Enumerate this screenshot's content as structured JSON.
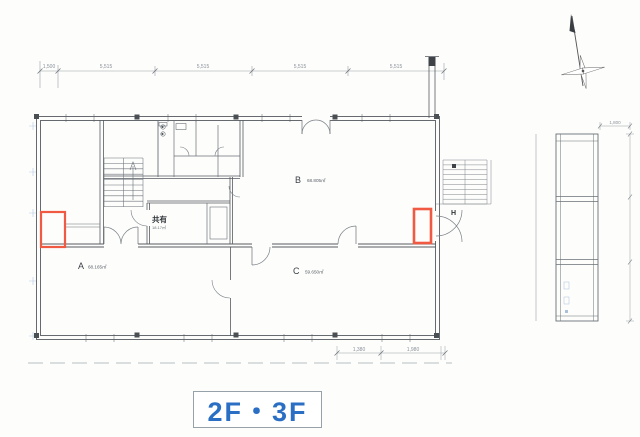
{
  "drawing": {
    "title": "2F・3F",
    "title_color": "#2b6fc4",
    "highlight_color": "#f05a43",
    "rooms": [
      {
        "id": "A",
        "area": "68.165㎡"
      },
      {
        "id": "B",
        "area": "68.805㎡"
      },
      {
        "id": "C",
        "area": "59.650㎡"
      },
      {
        "id": "共有",
        "area": "18.17㎡"
      },
      {
        "id": "H",
        "area": ""
      }
    ],
    "dimensions": {
      "top": [
        "1,500",
        "5,515",
        "5,515",
        "5,515",
        "5,515"
      ],
      "bottom": [
        "1,380",
        "1,980"
      ],
      "side": "1,800"
    },
    "icons": {
      "north_arrow": "compass-north-arrow"
    }
  }
}
